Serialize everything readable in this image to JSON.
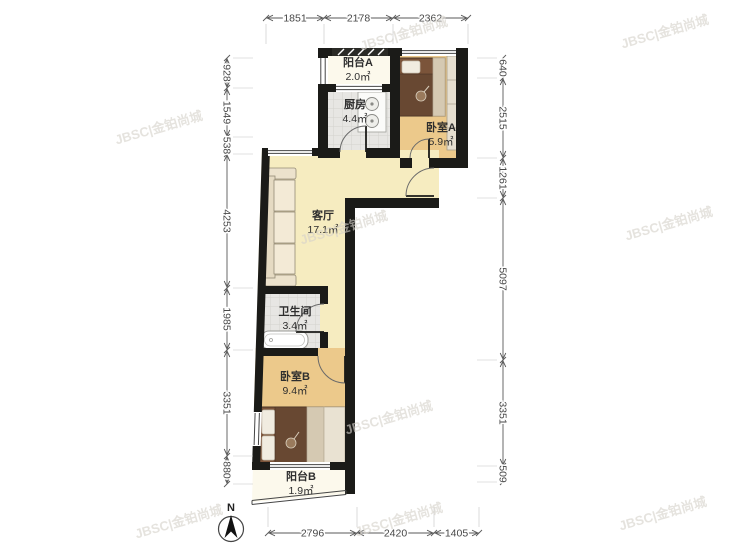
{
  "compass": {
    "label": "N"
  },
  "watermarks": {
    "text": "JBSC|金铂尚城",
    "positions": [
      {
        "x": 405,
        "y": 38
      },
      {
        "x": 666,
        "y": 36
      },
      {
        "x": 160,
        "y": 132
      },
      {
        "x": 345,
        "y": 232
      },
      {
        "x": 670,
        "y": 228
      },
      {
        "x": 390,
        "y": 422
      },
      {
        "x": 180,
        "y": 526
      },
      {
        "x": 400,
        "y": 524
      },
      {
        "x": 664,
        "y": 518
      }
    ]
  },
  "rooms": [
    {
      "name": "阳台A",
      "area": "2.0㎡"
    },
    {
      "name": "厨房",
      "area": "4.4㎡"
    },
    {
      "name": "卧室A",
      "area": "5.9㎡"
    },
    {
      "name": "客厅",
      "area": "17.1㎡"
    },
    {
      "name": "卫生间",
      "area": "3.4㎡"
    },
    {
      "name": "卧室B",
      "area": "9.4㎡"
    },
    {
      "name": "阳台B",
      "area": "1.9㎡"
    }
  ],
  "dimensions": [
    {
      "side": "top",
      "line": 18,
      "ticks": [
        266,
        324,
        393,
        468
      ],
      "labels": [
        "1851",
        "2178",
        "2362"
      ]
    },
    {
      "side": "left",
      "line": 227,
      "ticks": [
        58,
        88,
        137,
        154,
        288,
        350,
        456,
        484
      ],
      "labels": [
        "928",
        "1549",
        "538",
        "4253",
        "1985",
        "3351",
        "880"
      ]
    },
    {
      "side": "right",
      "line": 503,
      "ticks": [
        58,
        78,
        158,
        198,
        360,
        466,
        482
      ],
      "labels": [
        "640",
        "2515",
        "1261",
        "5097",
        "3351",
        "509"
      ]
    },
    {
      "side": "bottom",
      "line": 533,
      "ticks": [
        268,
        357,
        434,
        479
      ],
      "labels": [
        "2796",
        "2420",
        "1405"
      ]
    }
  ]
}
